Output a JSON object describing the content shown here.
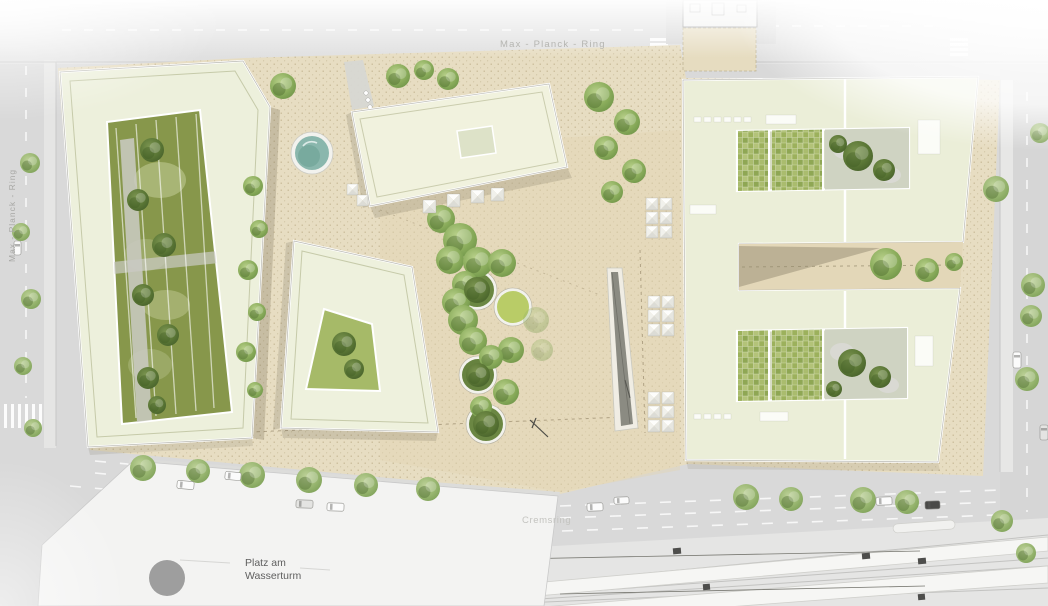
{
  "plan": {
    "title": "architectural site plan rendering",
    "labels": {
      "street_top": "Max - Planck - Ring",
      "street_left": "Max - Planck - Ring",
      "street_bottom": "Cremsring",
      "plaza_line1": "Platz am",
      "plaza_line2": "Wasserturm"
    },
    "palette": {
      "street_gray": "#d9d9d9",
      "site_ground_beige": "#e7ddc2",
      "roof_pale_green": "#eef0db",
      "roof_top_building": "#f1f2de",
      "courtyard_olive": "#87974b",
      "courtyard_light_green": "#a6ba68",
      "garden_checker_green": "#9cb15c",
      "tree_green": "#8aac5b",
      "tree_dark_green": "#5a7635",
      "pond_water_teal": "#8ab7ad",
      "planter_lawn": "#b9cc67",
      "canopy_white": "#fafaf7",
      "water_channel_dark": "#8b8b82",
      "plaza_white": "#f3f3f2",
      "tram_platform_white": "#f6f6f4",
      "water_tower_gray": "#9e9e9e",
      "label_gray": "#a8a8a5",
      "plaza_label_dark": "#5f5f5f"
    },
    "features": [
      {
        "name": "west-courtyard-block",
        "kind": "building"
      },
      {
        "name": "center-courtyard-block",
        "kind": "building"
      },
      {
        "name": "north-slab-block",
        "kind": "building"
      },
      {
        "name": "east-e-shaped-block",
        "kind": "building"
      },
      {
        "name": "existing-building-footprint",
        "kind": "building"
      },
      {
        "name": "circular-pond",
        "kind": "water"
      },
      {
        "name": "tree-planters",
        "kind": "landscape"
      },
      {
        "name": "canopy-pyramid-grids",
        "kind": "furniture"
      },
      {
        "name": "linear-water-channel",
        "kind": "water"
      },
      {
        "name": "tram-platforms",
        "kind": "transit"
      },
      {
        "name": "water-tower",
        "kind": "landmark"
      }
    ]
  }
}
